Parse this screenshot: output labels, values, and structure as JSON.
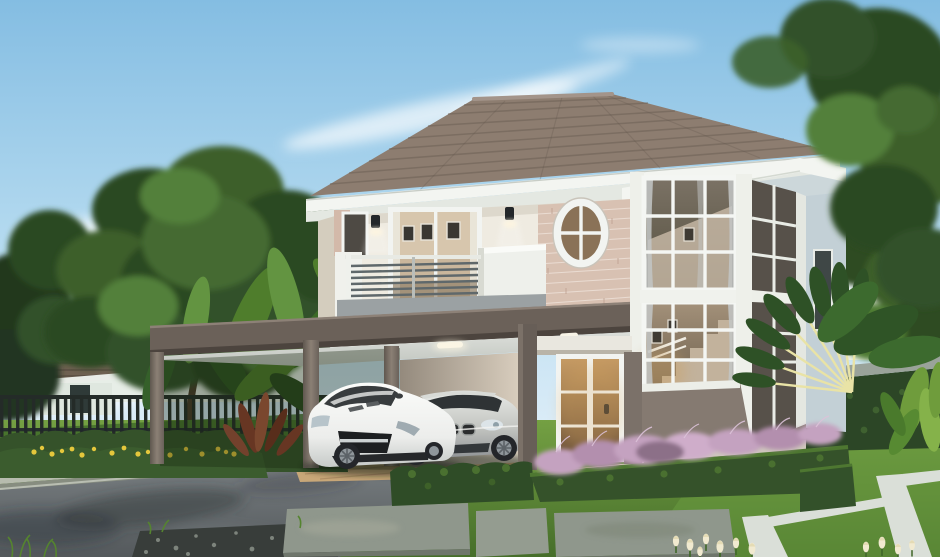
{
  "scene": {
    "type": "photorealistic architectural rendering",
    "setting": "suburban front yard, daytime, clear blue sky with wispy clouds",
    "main_house": {
      "stories": 2,
      "features": [
        "brown hip tile roof with white fascia",
        "second-floor balcony with gray bar railing",
        "sliding glass door",
        "oval window on stone-clad wall",
        "two wall lamps",
        "two-story corner window bay showing interior staircase",
        "carport on taupe columns",
        "white French glass entry door with warm interior light"
      ]
    },
    "vehicles": [
      {
        "type": "white sports coupe",
        "position": "under carport, left"
      },
      {
        "type": "silver sedan",
        "position": "under carport, right"
      }
    ],
    "landscape": [
      "large shade tree on left",
      "tall tree on right edge",
      "banana plants",
      "fan palm",
      "trimmed box hedges",
      "purple fountain grass",
      "yellow flower bed",
      "white tulips",
      "stone slab walkway",
      "white stone lawn borders",
      "gray driveway",
      "black picket fence",
      "raised concrete curb"
    ],
    "background": [
      "neighboring two-story house on left",
      "terracotta-roof house on right",
      "green hedge wall"
    ]
  },
  "colors": {
    "sky_top": "#84bde2",
    "sky_horizon": "#edf6fb",
    "cloud": "#ffffff",
    "roof_tile": "#8d7d70",
    "roof_tile_dark": "#6e6156",
    "fascia": "#f3f5f1",
    "soffit": "#e4e8e2",
    "frieze": "#ccd7da",
    "wall_cream": "#efebe1",
    "wall_shade": "#ddd6c8",
    "brick": "#d8c1b2",
    "brick_mortar": "#ecdfd6",
    "slab_taupe": "#6b6159",
    "balcony_base": "#9ba1a3",
    "rail_bar": "#5f686b",
    "mullion": "#f4f6f3",
    "glass_dark": "#554f48",
    "glass_warm": "#8a7257",
    "curtain": "#c3c6c6",
    "column": "#8a7f75",
    "column_dark": "#675e57",
    "carport_wall": "#d7cbba",
    "carport_ceiling": "#d0d4cf",
    "door_glow": "#b98a55",
    "side_wall": "#c3d0d6",
    "car_white": "#f2f3f1",
    "car_silver": "#c6c8c4",
    "tire": "#24262a",
    "grass": "#5f8c38",
    "grass_dark": "#3f6a28",
    "driveway": "#73797c",
    "paver": "#c8a778",
    "gravel": "#383d3a",
    "stone_slab": "#8f978c",
    "stone_strip": "#dadfd8",
    "hedge": "#35522a",
    "hedge_light": "#4e7731",
    "hedge_wall": "#2c4626",
    "hedge_wall_cap": "#9aa39a",
    "purple_grass": "#c4a2c0",
    "yellow_flower": "#e5c73c",
    "tulip": "#f1ead0",
    "red_plant": "#93402f",
    "fence": "#242b28",
    "bg_wall": "#e7eee7",
    "bg_roof": "#7e8a7e",
    "porch_roof_brown": "#6f6152",
    "orange_roof": "#b06f4c",
    "tree_dark": "#2c4a22",
    "tree_mid": "#3c5f2c",
    "tree_light": "#52803a",
    "banana": "#4f7d2c",
    "palm_stem": "#e9e3a6",
    "trunk": "#4a3b2b"
  }
}
